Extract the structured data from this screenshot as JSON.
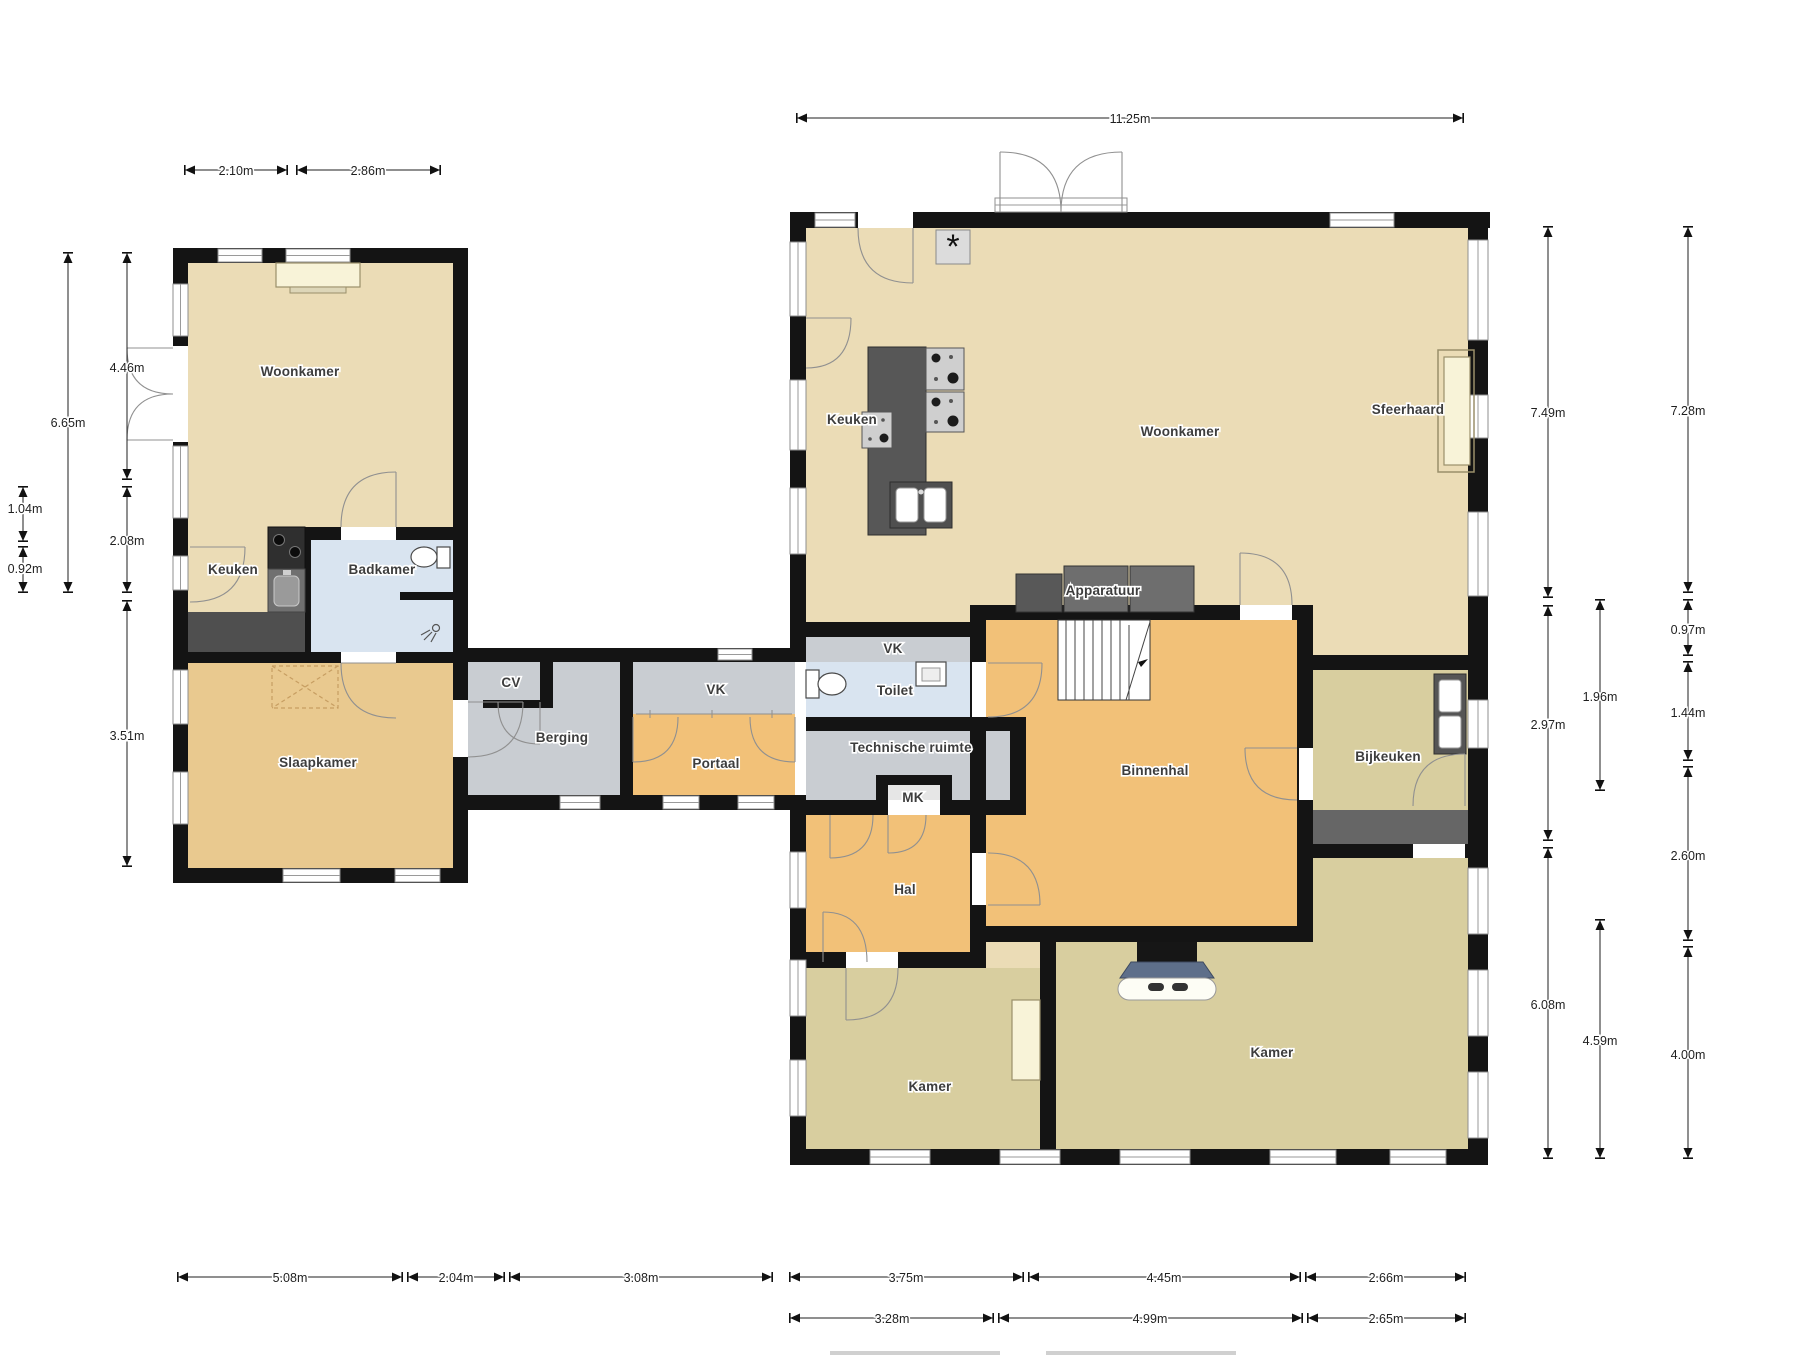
{
  "rooms": {
    "left": {
      "woonkamer": "Woonkamer",
      "keuken": "Keuken",
      "badkamer": "Badkamer",
      "slaapkamer": "Slaapkamer"
    },
    "link": {
      "cv": "CV",
      "berging": "Berging",
      "vk": "VK",
      "portaal": "Portaal"
    },
    "right": {
      "keuken": "Keuken",
      "woonkamer": "Woonkamer",
      "sfeerhaard": "Sfeerhaard",
      "apparatuur": "Apparatuur",
      "vk": "VK",
      "toilet": "Toilet",
      "technische_ruimte": "Technische ruimte",
      "mk": "MK",
      "binnenhal": "Binnenhal",
      "hal": "Hal",
      "bijkeuken": "Bijkeuken",
      "kamer_left": "Kamer",
      "kamer_right": "Kamer"
    }
  },
  "symbols": {
    "asterisk": "*"
  },
  "dimensions": {
    "top_left": [
      "2.10m",
      "2.86m"
    ],
    "top_right": [
      "11.25m"
    ],
    "left_outer": [
      "6.65m"
    ],
    "left_offsets": [
      "1.04m",
      "0.92m"
    ],
    "left_inner": [
      "4.46m",
      "2.08m",
      "3.51m"
    ],
    "right_col1": [
      "7.49m",
      "2.97m",
      "6.08m"
    ],
    "right_col2": [
      "1.96m",
      "4.59m"
    ],
    "right_col3": [
      "7.28m",
      "0.97m",
      "1.44m",
      "2.60m",
      "4.00m"
    ],
    "bottom_row1": [
      "5.08m",
      "2.04m",
      "3.08m",
      "3.75m",
      "4.45m",
      "2.66m"
    ],
    "bottom_row2": [
      "3.28m",
      "4.99m",
      "2.65m"
    ]
  },
  "colors": {
    "wall": "#141414",
    "living_beige": "#EBDCB6",
    "bedroom_tan": "#E9C98F",
    "hall_orange": "#F2C178",
    "room_olive": "#D8CE9F",
    "utility_grey": "#C9CDD2",
    "bath_blue": "#D9E4F0",
    "counter_dark": "#4F4F4F",
    "appliance_grey": "#6E6E6E",
    "accent_pale": "#F8F3D8",
    "stove_slate": "#5E6F8A"
  }
}
